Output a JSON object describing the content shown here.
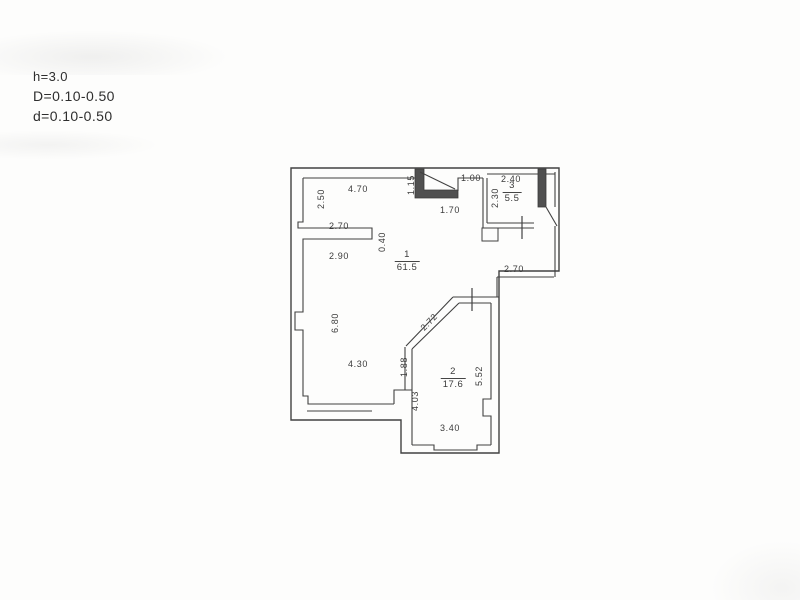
{
  "header": {
    "line1": "h=3.0",
    "line2": "D=0.10-0.50",
    "line3": "d=0.10-0.50"
  },
  "rooms": [
    {
      "number": "1",
      "area": "61.5"
    },
    {
      "number": "2",
      "area": "17.6"
    },
    {
      "number": "3",
      "area": "5.5"
    }
  ],
  "dimensions": [
    {
      "label": "2.50"
    },
    {
      "label": "4.70"
    },
    {
      "label": "1.15"
    },
    {
      "label": "1.70"
    },
    {
      "label": "1.00"
    },
    {
      "label": "2.40"
    },
    {
      "label": "2.30"
    },
    {
      "label": "2.70"
    },
    {
      "label": "0.40"
    },
    {
      "label": "2.90"
    },
    {
      "label": "2.70"
    },
    {
      "label": "2.72"
    },
    {
      "label": "6.80"
    },
    {
      "label": "4.30"
    },
    {
      "label": "1.88"
    },
    {
      "label": "5.52"
    },
    {
      "label": "4.03"
    },
    {
      "label": "3.40"
    }
  ],
  "colors": {
    "line": "#414141",
    "thick_wall_fill": "#505050",
    "text": "#3b3b3b",
    "paper": "#fdfdfc"
  }
}
